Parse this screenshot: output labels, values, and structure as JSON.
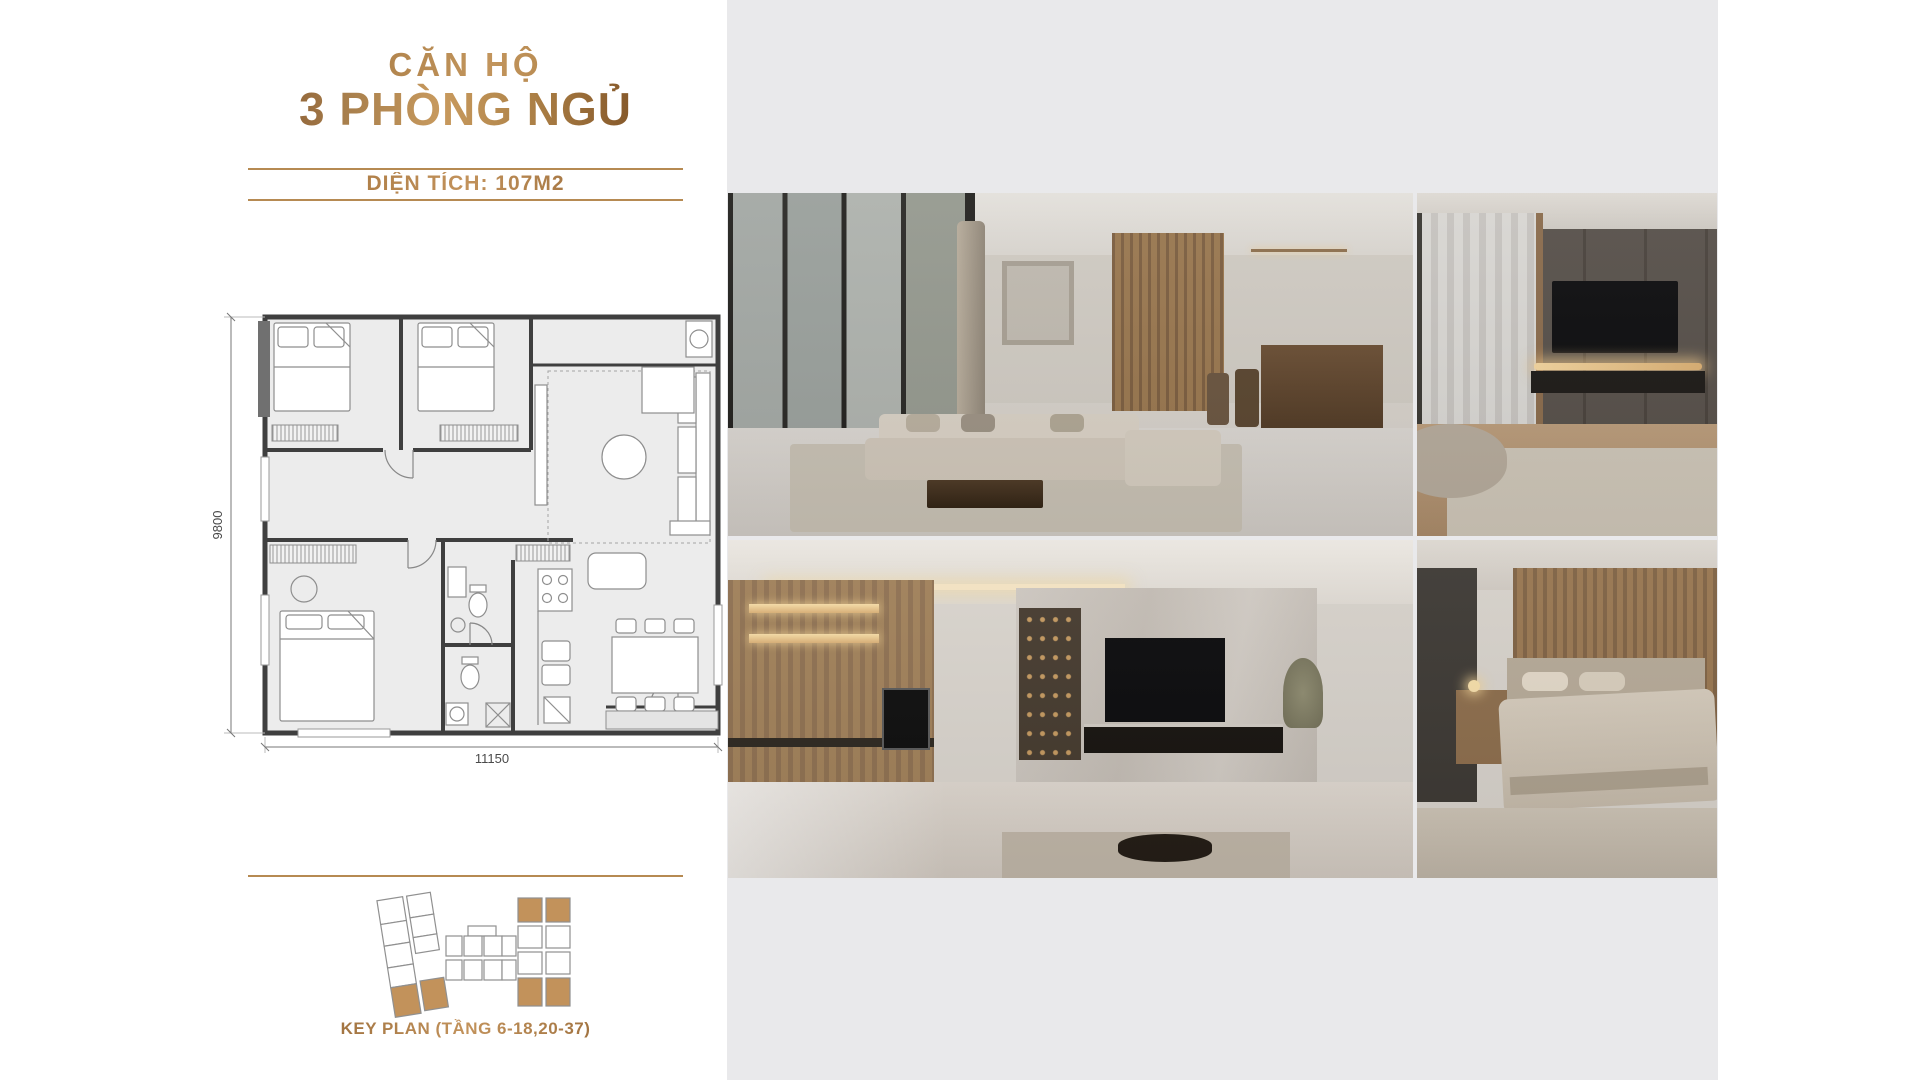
{
  "colors": {
    "accent_gold": "#B08449",
    "bronze_dark": "#6F431F",
    "divider_line": "#B68A52",
    "panel_gray": "#E9E9EB",
    "keyplan_highlight": "#C2925B"
  },
  "header": {
    "title_line1": "CĂN HỘ",
    "title_line2": "3 PHÒNG NGỦ",
    "area_label": "DIỆN TÍCH: 107M2"
  },
  "floor_plan": {
    "height_label": "9800",
    "width_label": "11150"
  },
  "key_plan": {
    "caption": "KEY PLAN (TẦNG 6-18,20-37)"
  },
  "photos": [
    {
      "label": "living room"
    },
    {
      "label": "tv lounge"
    },
    {
      "label": "kitchen and tv feature wall"
    },
    {
      "label": "bedroom"
    }
  ]
}
